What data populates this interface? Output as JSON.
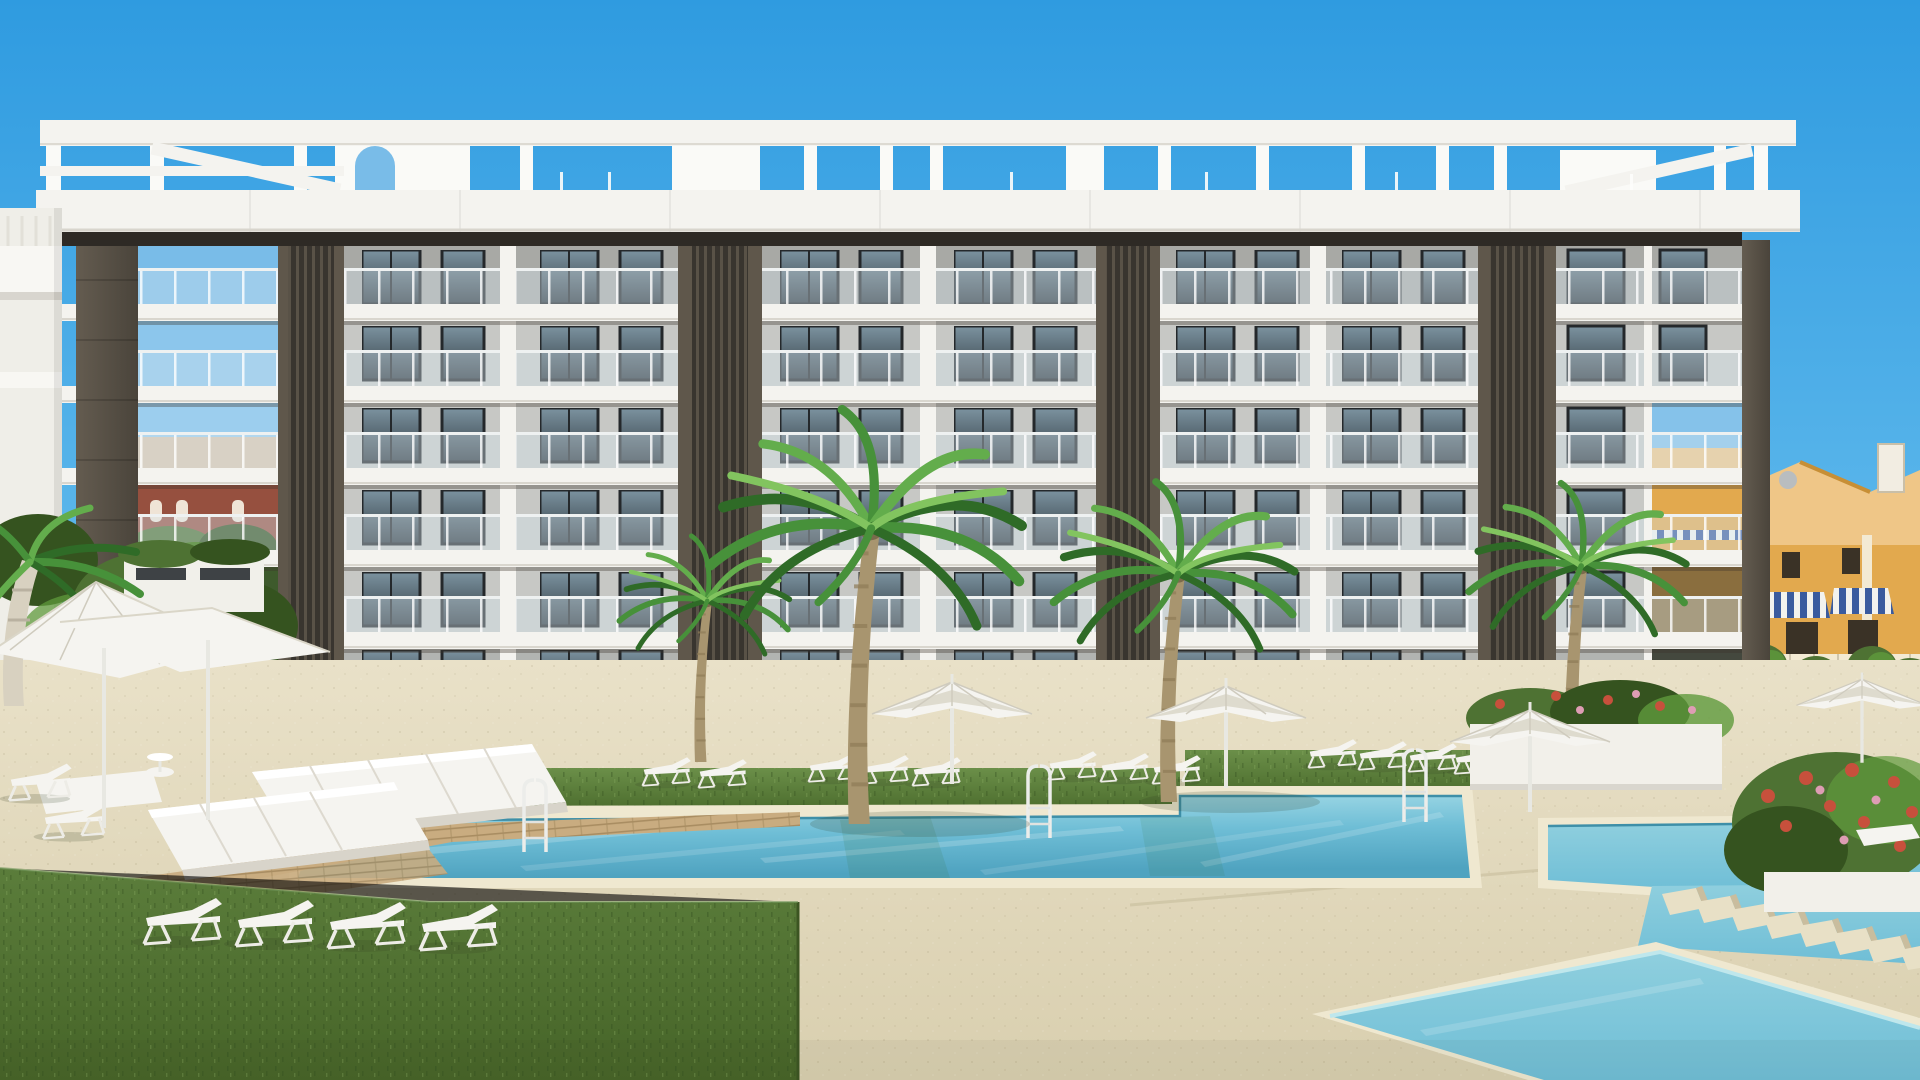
{
  "meta": {
    "scene_type": "3d-architectural-rendering",
    "description": "New-build residential complex: white 6-level apartment building with dark louvered columns and rooftop pergola, communal pools with sun loungers, parasols and palm trees"
  },
  "palette": {
    "sky_top": "#2F9BE0",
    "sky_mid": "#5FB9EC",
    "sky_low": "#A8DCF5",
    "white": "#F4F3EF",
    "white_bright": "#FAFAF7",
    "slab_edge": "#DBD8D0",
    "under_shadow": "#2E2A25",
    "facade": "#C7C8C5",
    "facade_dark": "#B2B4B1",
    "facade_side": "#8E908D",
    "win_frame": "#24282B",
    "win_glass_t": "#7C93A0",
    "win_glass_b": "#303A41",
    "louver": "#39352F",
    "louver_hi": "#5F574B",
    "pillar": "#645C50",
    "pillar_dark": "#4A443B",
    "base_wall": "#F1F0EB",
    "sand": "#E9E1C8",
    "sand_dark": "#D9CFAF",
    "grass": "#6B8F49",
    "grass_dark": "#4F7030",
    "lawn": "#5B7D3B",
    "lawn_dark": "#466428",
    "water_hi": "#A4DBE7",
    "water": "#6FBED6",
    "water_deep": "#4FA3C0",
    "waterline": "#3E8FA8",
    "water2": "#8FCFDE",
    "wood": "#C9AC80",
    "wood_dark": "#A98D62",
    "furn": "#F5F4F0",
    "furn_shade": "#D8D4CA",
    "house": "#E2A94E",
    "house_hi": "#EFC687",
    "house_trim": "#F3EAD3",
    "roof_edge": "#B07A30",
    "awn_blue": "#3A5B9E",
    "fence": "#393C3E",
    "terrace": "#9EA09B",
    "shrub": "#4E7233",
    "shrub_dark": "#35531F",
    "leaf": "#5F9A3C",
    "flw_pink": "#DE9DB4",
    "flw_red": "#C7503C",
    "flw_white": "#F3F3EE",
    "flw_lav": "#A79BD0",
    "old_red": "#96493B",
    "old_cream": "#E2CCB2",
    "old_teal": "#417E8C",
    "old_roof": "#A9674A",
    "trunk": "#A8956F",
    "trunk_dark": "#8F7C58",
    "trunk_pale": "#D8D1C0",
    "frond1": "#2F6B27",
    "frond2": "#47913A",
    "frond3": "#63AD4C",
    "frond4": "#82C45F"
  },
  "scene": {
    "building": {
      "balcony_levels": 6,
      "bays": 5,
      "louver_columns": 5,
      "rooftop": "white pergola frame"
    },
    "pools": 3,
    "stepping_stones": 8,
    "palm_trees": 6,
    "parasols": 7,
    "sun_loungers": 21,
    "daybeds": 3,
    "pool_ladders": 3,
    "background_left": "old town facades behind trees",
    "background_right": "yellow townhouses with striped awnings"
  }
}
